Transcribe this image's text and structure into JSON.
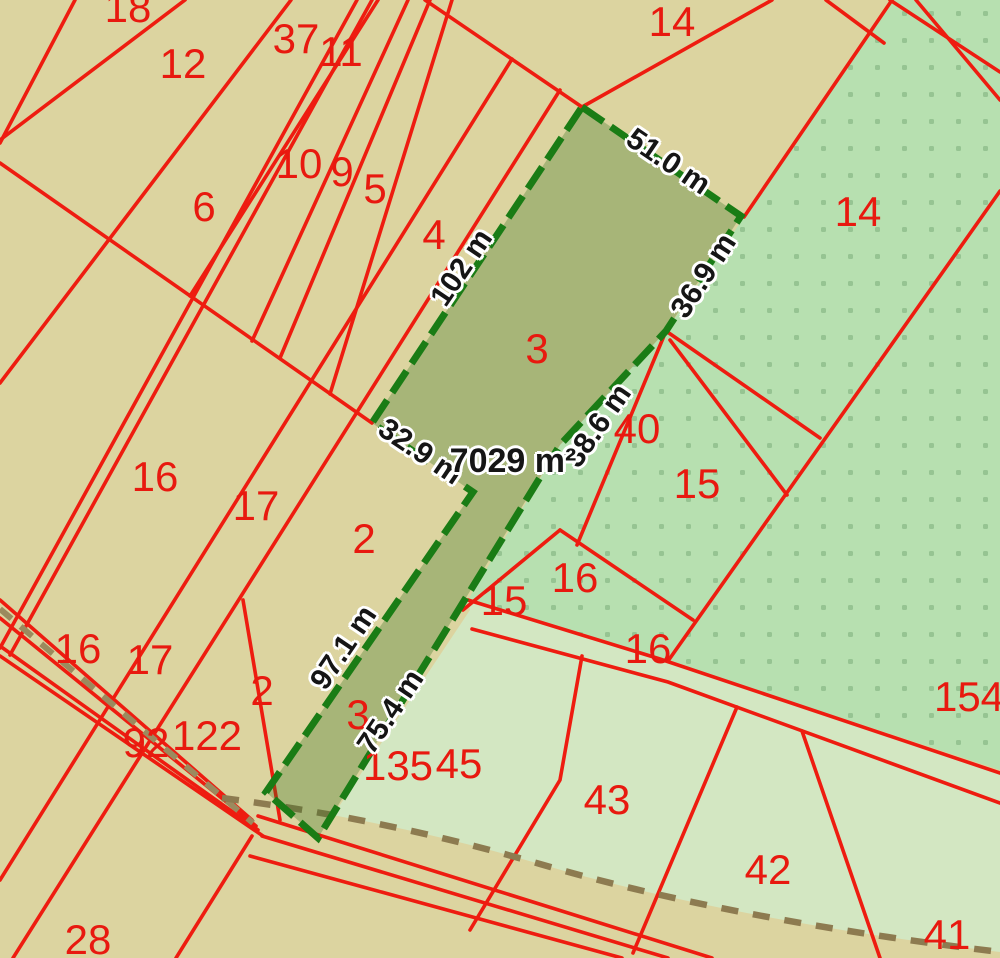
{
  "map": {
    "type": "cadastral-parcel-map",
    "highlighted_parcel": {
      "number": "3",
      "area_label": "7029 m²",
      "side_lengths": [
        "51.0 m",
        "36.9 m",
        "38.6 m",
        "75.4 m",
        "97.1 m",
        "32.9 m",
        "102 m"
      ],
      "outline_color": "#1a7c15",
      "fill_color": "rgba(45,110,30,0.30)"
    },
    "colors": {
      "background_tan": "#dcd4a0",
      "pale_green_area": "#d3e7c2",
      "dotted_green_area": "#b7e0b0",
      "dotted_green_dots": "#96c492",
      "boundary_red": "#ee1c10",
      "label_red": "#e8190f",
      "measure_text": "#151515",
      "track_dash_brown": "#9b8a5e"
    },
    "parcel_labels": [
      {
        "n": "18",
        "x": 128,
        "y": 8
      },
      {
        "n": "12",
        "x": 183,
        "y": 64
      },
      {
        "n": "37",
        "x": 296,
        "y": 39
      },
      {
        "n": "11",
        "x": 341,
        "y": 52
      },
      {
        "n": "14",
        "x": 672,
        "y": 22
      },
      {
        "n": "6",
        "x": 204,
        "y": 207
      },
      {
        "n": "10",
        "x": 299,
        "y": 164
      },
      {
        "n": "9",
        "x": 342,
        "y": 172
      },
      {
        "n": "5",
        "x": 375,
        "y": 189
      },
      {
        "n": "4",
        "x": 434,
        "y": 235
      },
      {
        "n": "3",
        "x": 537,
        "y": 349
      },
      {
        "n": "14",
        "x": 858,
        "y": 212
      },
      {
        "n": "40",
        "x": 637,
        "y": 429
      },
      {
        "n": "15",
        "x": 697,
        "y": 484
      },
      {
        "n": "16",
        "x": 155,
        "y": 477
      },
      {
        "n": "17",
        "x": 256,
        "y": 506
      },
      {
        "n": "2",
        "x": 364,
        "y": 539
      },
      {
        "n": "16",
        "x": 575,
        "y": 578
      },
      {
        "n": "16",
        "x": 78,
        "y": 649
      },
      {
        "n": "17",
        "x": 150,
        "y": 660
      },
      {
        "n": "2",
        "x": 262,
        "y": 691
      },
      {
        "n": "92",
        "x": 146,
        "y": 743
      },
      {
        "n": "122",
        "x": 207,
        "y": 736
      },
      {
        "n": "15",
        "x": 504,
        "y": 601
      },
      {
        "n": "16",
        "x": 648,
        "y": 649
      },
      {
        "n": "3",
        "x": 358,
        "y": 715
      },
      {
        "n": "135",
        "x": 398,
        "y": 766
      },
      {
        "n": "45",
        "x": 459,
        "y": 764
      },
      {
        "n": "154",
        "x": 969,
        "y": 697
      },
      {
        "n": "43",
        "x": 607,
        "y": 800
      },
      {
        "n": "42",
        "x": 768,
        "y": 870
      },
      {
        "n": "41",
        "x": 947,
        "y": 935
      },
      {
        "n": "28",
        "x": 88,
        "y": 940
      }
    ],
    "measurement_labels": [
      {
        "t": "51.0 m",
        "x": 668,
        "y": 162,
        "r": 34,
        "area": false
      },
      {
        "t": "102 m",
        "x": 462,
        "y": 268,
        "r": -56,
        "area": false
      },
      {
        "t": "36.9 m",
        "x": 704,
        "y": 276,
        "r": -57,
        "area": false
      },
      {
        "t": "38.6 m",
        "x": 598,
        "y": 426,
        "r": -55,
        "area": false
      },
      {
        "t": "32.9 m",
        "x": 420,
        "y": 452,
        "r": 34,
        "area": false
      },
      {
        "t": "97.1 m",
        "x": 344,
        "y": 648,
        "r": -56,
        "area": false
      },
      {
        "t": "75.4 m",
        "x": 391,
        "y": 712,
        "r": -56,
        "area": false
      },
      {
        "t": "7029 m²",
        "x": 513,
        "y": 461,
        "r": 0,
        "area": true
      }
    ]
  }
}
